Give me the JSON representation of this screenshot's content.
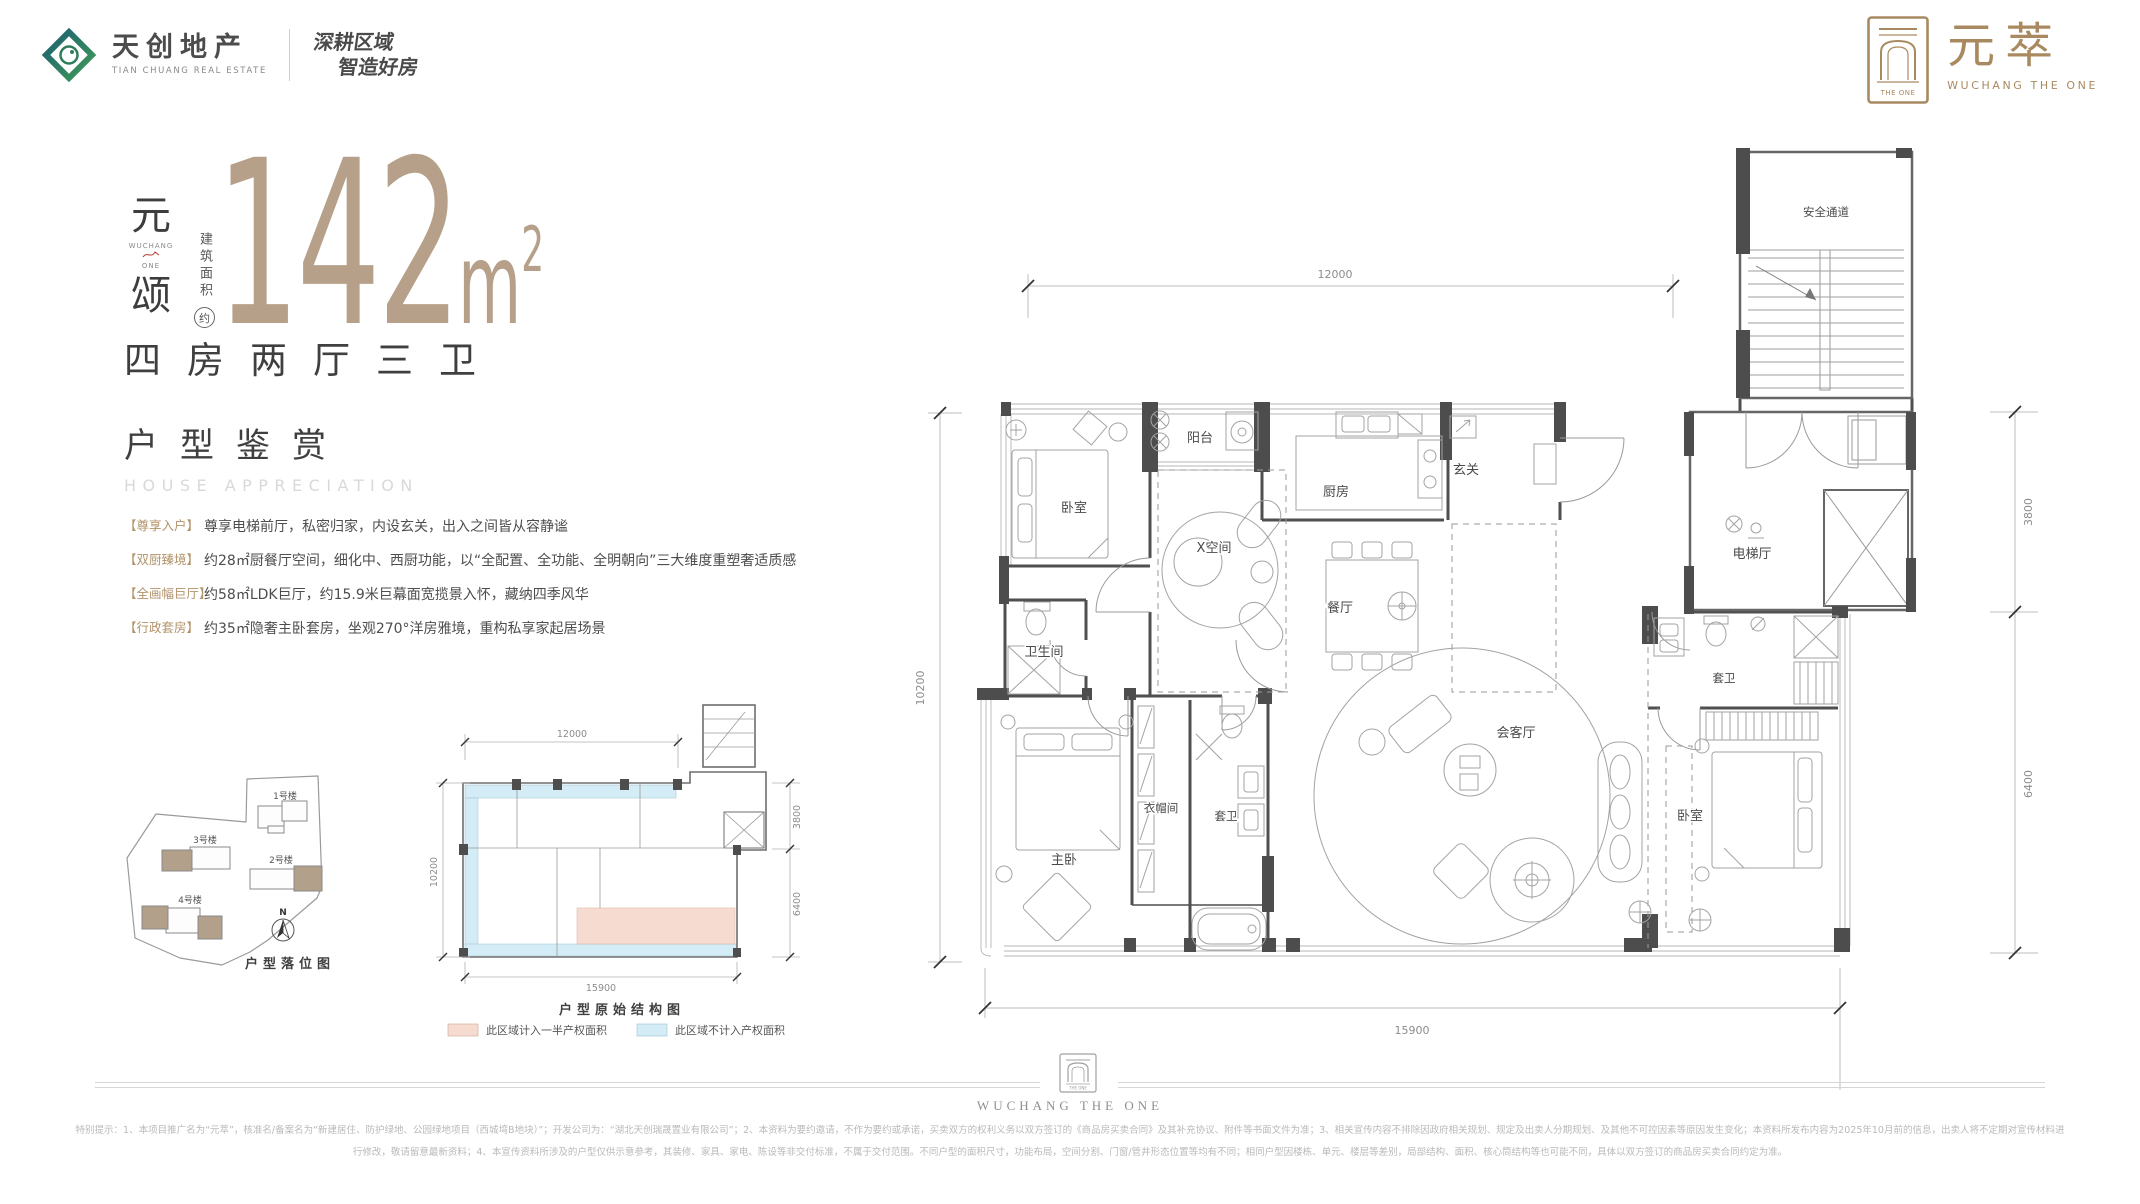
{
  "brand": {
    "developer_name": "天创地产",
    "developer_name_en": "TIAN CHUANG REAL ESTATE",
    "slogan_line1": "深耕区域",
    "slogan_line2": "智造好房",
    "project_name": "元萃",
    "project_name_en": "WUCHANG THE ONE",
    "emblem_text": "THE ONE",
    "gold": "#a98a60",
    "logo_teal": "#1d5e74",
    "logo_green": "#3f9b55"
  },
  "hero": {
    "series_char_top": "元",
    "series_sub_top": "WUCHANG",
    "series_sub_bottom": "ONE",
    "series_char_bottom": "颂",
    "area_label_vertical": "建筑面积",
    "area_approx_badge": "约",
    "area_value": "142",
    "area_unit_m": "m",
    "area_unit_sup": "2",
    "accent_tan": "#b7a08a",
    "layout_text": "四房两厅三卫",
    "section_title": "户型鉴赏",
    "section_subtitle": "HOUSE APPRECIATION"
  },
  "features": [
    {
      "tag": "【尊享入户】",
      "text": "尊享电梯前厅，私密归家，内设玄关，出入之间皆从容静谧"
    },
    {
      "tag": "【双厨臻境】",
      "text": "约28㎡厨餐厅空间，细化中、西厨功能，以“全配置、全功能、全明朝向”三大维度重塑奢适质感"
    },
    {
      "tag": "【全画幅巨厅】",
      "text": "约58㎡LDK巨厅，约15.9米巨幕面宽揽景入怀，藏纳四季风华"
    },
    {
      "tag": "【行政套房】",
      "text": "约35㎡隐奢主卧套房，坐观270°洋房雅境，重构私享家起居场景"
    }
  ],
  "site_plan": {
    "caption": "户型落位图",
    "north": "N",
    "buildings": [
      "1号楼",
      "2号楼",
      "3号楼",
      "4号楼"
    ],
    "highlight_color": "#b3a08b"
  },
  "structural_plan": {
    "caption": "户型原始结构图",
    "dim_top": "12000",
    "dim_left": "10200",
    "dim_bottom": "15900",
    "dim_right_upper": "3800",
    "dim_right_lower": "6400",
    "legend": [
      {
        "swatch": "#f6dcd0",
        "label": "此区域计入一半产权面积"
      },
      {
        "swatch": "#d3ecf5",
        "label": "此区域不计入产权面积"
      }
    ]
  },
  "floor_plan": {
    "dim_top": "12000",
    "dim_left": "10200",
    "dim_bottom": "15900",
    "dim_right_upper": "3800",
    "dim_right_lower": "6400",
    "rooms": {
      "bedroom_tl": "卧室",
      "balcony": "阳台",
      "kitchen": "厨房",
      "foyer": "玄关",
      "x_space": "X空间",
      "dining": "餐厅",
      "bathroom": "卫生间",
      "master": "主卧",
      "cloakroom": "衣帽间",
      "ensuite_master": "套卫",
      "living": "会客厅",
      "bedroom_r": "卧室",
      "ensuite_r": "套卫",
      "elevator_hall": "电梯厅",
      "fire_stair": "安全通道"
    }
  },
  "footer": {
    "brand_en": "WUCHANG THE ONE",
    "disclaimer_line1": "特别提示：1、本项目推广名为“元萃”，核准名/备案名为“新建居住、防护绿地、公园绿地项目（西城塆B地块）”；开发公司为：“湖北天创瑞晟置业有限公司”；2、本资料为要约邀请，不作为要约或承诺，买卖双方的权利义务以双方签订的《商品房买卖合同》及其补充协议、附件等书面文件为准；3、相关宣传内容不排除因政府相关规划、规定及出卖人分期规划、及其他不可控因素等原因发生变化；本资料所发布内容为2025年10月前的信息，出卖人将不定期对宣传材料进",
    "disclaimer_line2": "行修改，敬请留意最新资料；4、本宣传资料所涉及的户型仅供示意参考，其装修、家具、家电、陈设等非交付标准，不属于交付范围。不同户型的面积尺寸，功能布局，空间分割、门窗/管井形态位置等均有不同；相同户型因楼栋、单元、楼层等差别，局部结构、面积、核心筒结构等也可能不同，具体以双方签订的商品房买卖合同约定为准。"
  }
}
